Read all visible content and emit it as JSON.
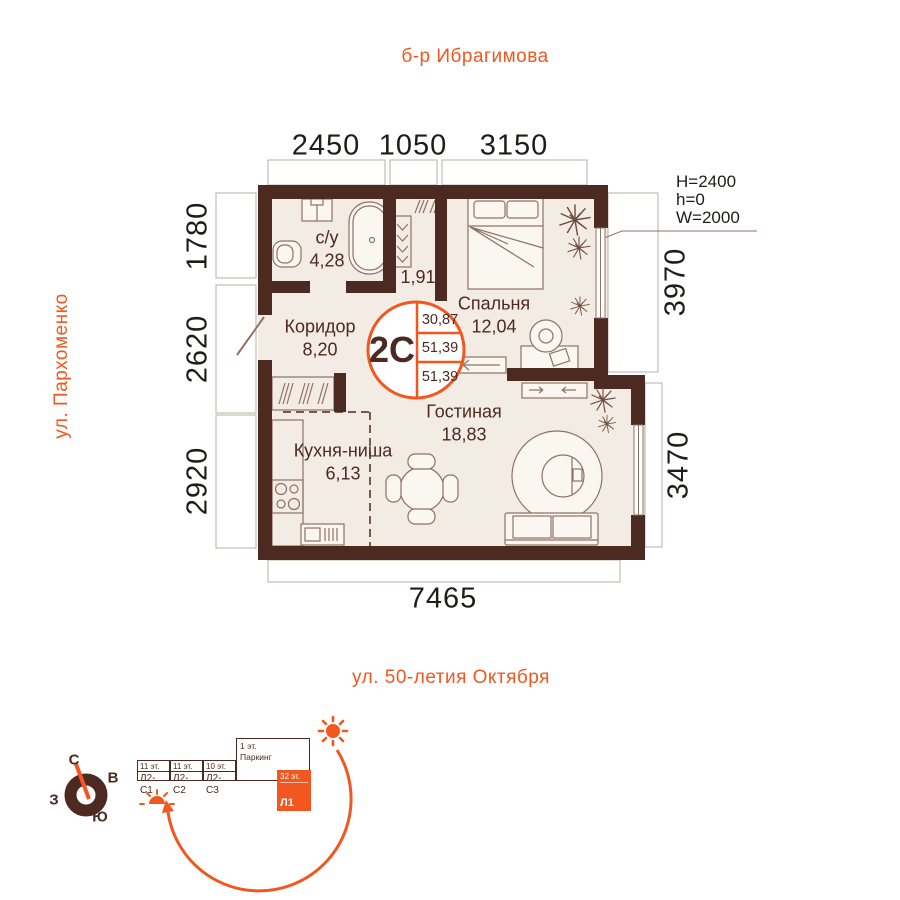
{
  "streets": {
    "top": "б-р Ибрагимова",
    "left": "ул. Пархоменко",
    "bottom": "ул. 50-летия Октября"
  },
  "dims": {
    "top_1": "2450",
    "top_2": "1050",
    "top_3": "3150",
    "left_1": "1780",
    "left_2": "2620",
    "left_3": "2920",
    "right_1": "3970",
    "right_2": "3470",
    "bottom": "7465"
  },
  "window_spec": {
    "line1": "H=2400",
    "line2": "h=0",
    "line3": "W=2000"
  },
  "rooms": {
    "bathroom": {
      "name": "с/у",
      "area": "4,28"
    },
    "wardrobe": {
      "area": "1,91"
    },
    "bedroom": {
      "name": "Спальня",
      "area": "12,04"
    },
    "hall": {
      "name": "Коридор",
      "area": "8,20"
    },
    "kitchen": {
      "name": "Кухня-ниша",
      "area": "6,13"
    },
    "living": {
      "name": "Гостиная",
      "area": "18,83"
    }
  },
  "badge": {
    "type": "2С",
    "v1": "30,87",
    "v2": "51,39",
    "v3": "51,39"
  },
  "site": {
    "b1_floors": "11 эт.",
    "b1_name": "Л2-С1",
    "b2_floors": "11 эт.",
    "b2_name": "Л2-С2",
    "b3_floors": "10 эт.",
    "b3_name": "Л2-С3",
    "parking_floors": "1 эт.",
    "parking_name": "Паркинг",
    "tower_floors": "32 эт.",
    "tower_name": "Л1",
    "compass": {
      "n": "С",
      "e": "В",
      "s": "Ю",
      "w": "З"
    }
  },
  "colors": {
    "accent": "#f1571f",
    "wall": "#4c2a21",
    "floor": "#f2ece4"
  }
}
